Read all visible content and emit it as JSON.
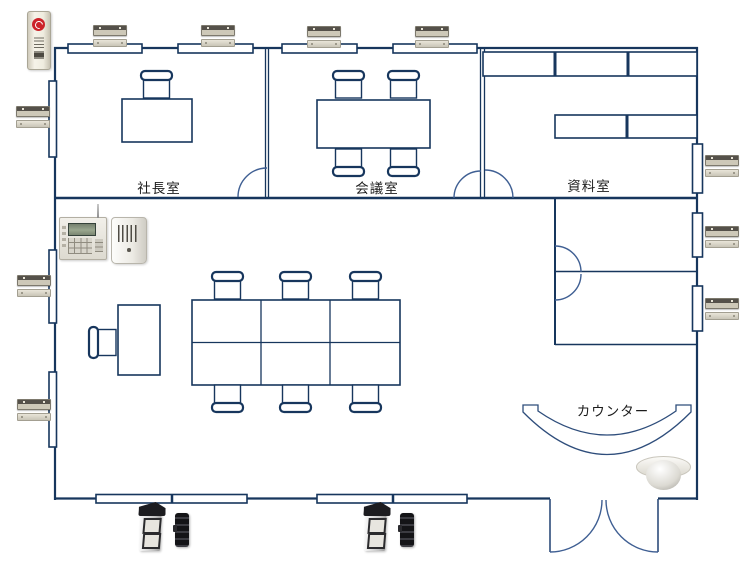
{
  "diagram": {
    "type": "office-security-floor-plan"
  },
  "rooms": {
    "presidents_office": {
      "label": "社長室"
    },
    "meeting_room": {
      "label": "会議室"
    },
    "document_room": {
      "label": "資料室"
    },
    "counter": {
      "label": "カウンター"
    }
  },
  "devices": {
    "security_sign": {
      "name": "security-status-sign",
      "count": 1,
      "logo_icon": "red-circle-logo"
    },
    "control_panel": {
      "name": "alarm-control-panel",
      "count": 1
    },
    "indoor_siren": {
      "name": "indoor-siren-unit",
      "count": 1
    },
    "magnetic_contact": {
      "name": "magnetic-contact-sensor",
      "count": 10
    },
    "outdoor_beam_sensor": {
      "name": "outdoor-beam-sensor-pair",
      "count": 2
    },
    "ceiling_sensor": {
      "name": "ceiling-dome-sensor",
      "count": 1
    }
  },
  "colors": {
    "wall": "#17365d",
    "door_arc": "#3f5f93",
    "sign_logo_red": "#cc2229",
    "background": "#ffffff"
  }
}
